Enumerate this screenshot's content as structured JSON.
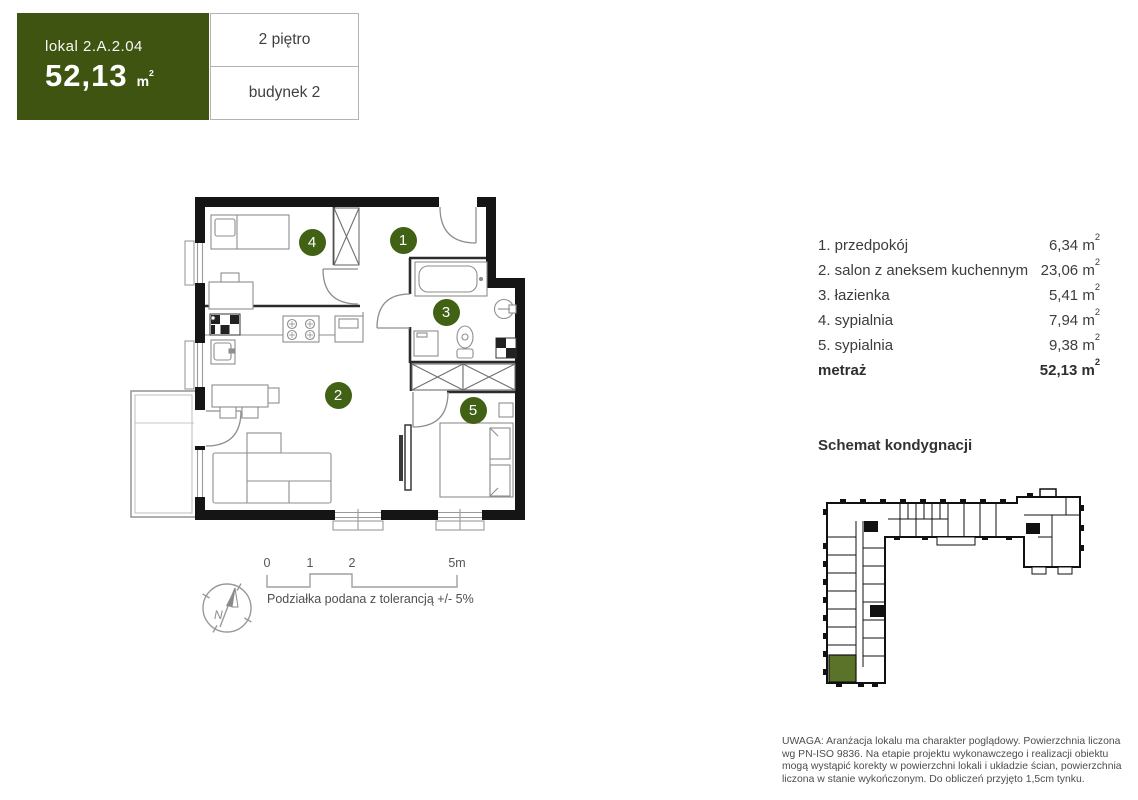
{
  "header": {
    "unit_label": "lokal 2.A.2.04",
    "area_value": "52,13",
    "area_unit_base": "m",
    "area_unit_sup": "2",
    "floor": "2 piętro",
    "building": "budynek 2"
  },
  "legend": {
    "rooms": [
      {
        "label": "1. przedpokój",
        "value": "6,34"
      },
      {
        "label": "2. salon z aneksem kuchennym",
        "value": "23,06"
      },
      {
        "label": "3. łazienka",
        "value": "5,41"
      },
      {
        "label": "4. sypialnia",
        "value": "7,94"
      },
      {
        "label": "5. sypialnia",
        "value": "9,38"
      }
    ],
    "unit_base": "m",
    "unit_sup": "2",
    "total_label": "metraż",
    "total_value": "52,13"
  },
  "floorplan": {
    "markers": [
      {
        "num": "1",
        "x": 278,
        "y": 55
      },
      {
        "num": "2",
        "x": 213,
        "y": 210
      },
      {
        "num": "3",
        "x": 321,
        "y": 127
      },
      {
        "num": "4",
        "x": 187,
        "y": 57
      },
      {
        "num": "5",
        "x": 348,
        "y": 225
      }
    ]
  },
  "scale_bar": {
    "tick_0": "0",
    "tick_1": "1",
    "tick_2": "2",
    "tick_5": "5m",
    "note": "Podziałka podana z tolerancją +/- 5%",
    "compass": "N"
  },
  "schematic": {
    "title": "Schemat kondygnacji"
  },
  "disclaimer": "UWAGA: Aranżacja lokalu ma charakter poglądowy. Powierzchnia liczona wg PN-ISO 9836. Na etapie projektu wykonawczego i realizacji obiektu mogą wystąpić korekty w powierzchni lokali i układzie ścian, powierzchnia liczona w stanie wykończonym. Do obliczeń przyjęto 1,5cm tynku.",
  "colors": {
    "accent": "#3f5410",
    "marker": "#416114",
    "highlight": "#5a7328"
  }
}
